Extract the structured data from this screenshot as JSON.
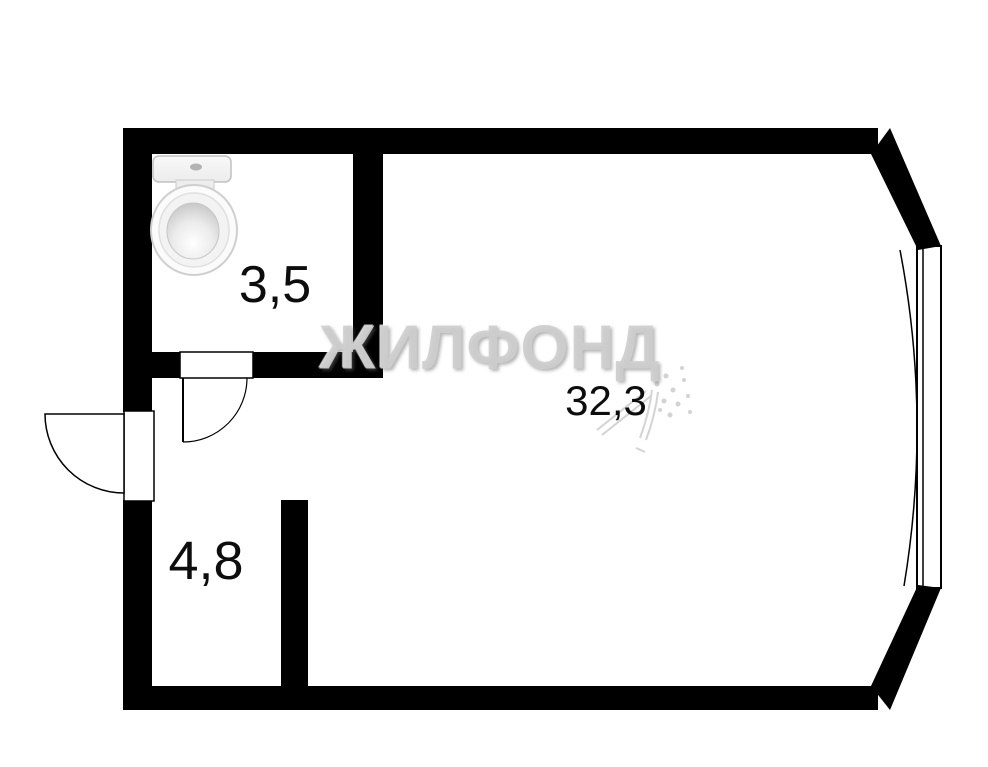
{
  "floor_plan": {
    "watermark_text": "ЖИЛФОНД",
    "rooms": [
      {
        "id": "bathroom",
        "area_label": "3,5"
      },
      {
        "id": "hallway",
        "area_label": "4,8"
      },
      {
        "id": "living_room",
        "area_label": "32,3"
      }
    ],
    "icons": {
      "toilet": "toilet-top-view-icon"
    },
    "colors": {
      "wall": "#000000",
      "background": "#ffffff",
      "watermark": "#cecece",
      "label_text": "#0d0d0d",
      "fixture_fill": "#f4f4f4",
      "fixture_outline": "#c0c0c0"
    }
  }
}
